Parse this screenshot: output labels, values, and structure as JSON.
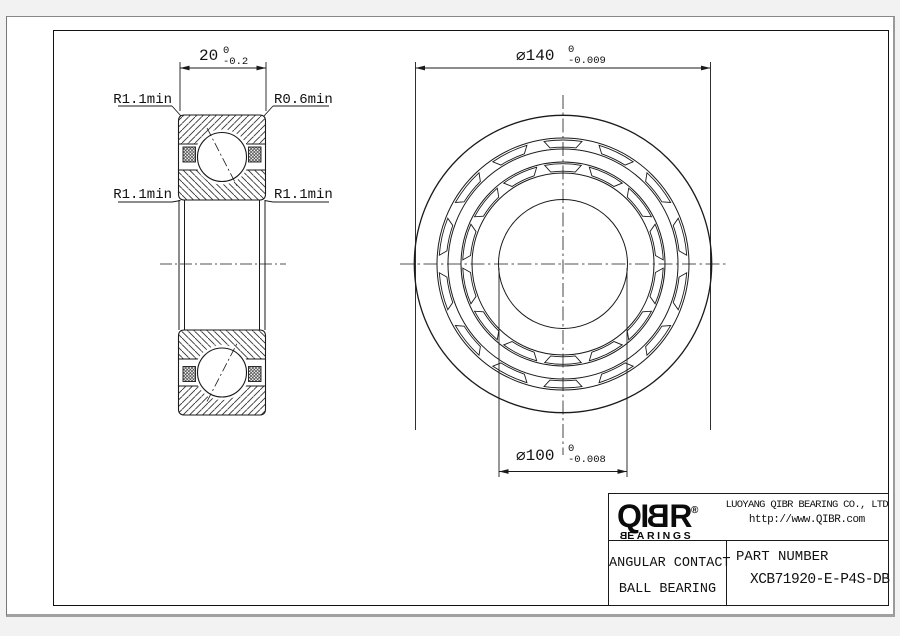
{
  "drawing": {
    "section_view": {
      "width_dim": {
        "text": "20",
        "tol_upper": "0",
        "tol_lower": "-0.2"
      },
      "labels": {
        "top_left": "R1.1min",
        "top_right": "R0.6min",
        "mid_left": "R1.1min",
        "mid_right": "R1.1min"
      }
    },
    "front_view": {
      "outer_dia": {
        "text": "⌀140",
        "tol_upper": "0",
        "tol_lower": "-0.009"
      },
      "bore_dia": {
        "text": "⌀100",
        "tol_upper": "0",
        "tol_lower": "-0.008"
      }
    }
  },
  "title_block": {
    "logo": {
      "letters_pre": "QI",
      "letter_mirrored": "B",
      "letters_post": "R",
      "registered": "®",
      "sub_mirrored": "B",
      "sub_rest": "EARINGS"
    },
    "company": "LUOYANG QIBR BEARING CO., LTD",
    "website": "http://www.QIBR.com",
    "product_line1": "ANGULAR CONTACT",
    "product_line2": "BALL BEARING",
    "part_label": "PART NUMBER",
    "part_number": "XCB71920-E-P4S-DB"
  },
  "colors": {
    "line": "#1a1a1a",
    "paper": "#ffffff"
  }
}
